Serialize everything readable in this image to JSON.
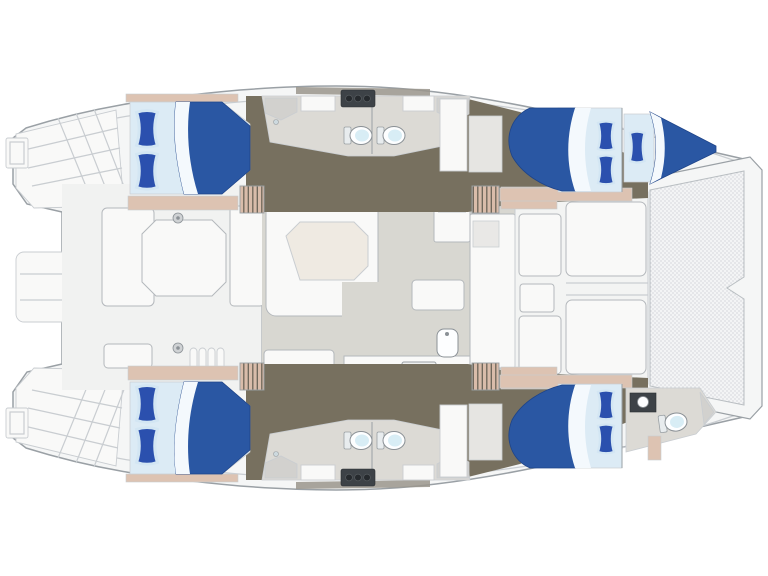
{
  "image": {
    "description": "Top-down 2D floor plan drawing of a sailing catamaran yacht, bow to the right, stern to the left, no visible text",
    "width_px": 768,
    "height_px": 576
  },
  "palette": {
    "deck": "#f5f6f6",
    "deck_line": "#9aa0a5",
    "deck_line_soft": "#c9cdd1",
    "hull_floor": "#77705f",
    "bed_blue_dark": "#1e4489",
    "cabin_shelf_tan": "#ddc3b2",
    "step_tan": "#d9bcaa",
    "step_stripe": "#6b6458",
    "salon_floor": "#d8d7d1",
    "head_floor": "#dcdad5",
    "furniture": "#f9f9f8",
    "furniture_line": "#b4b8bc",
    "table": "#efeae2",
    "bed_blue": "#2a57a3",
    "pillow_blue": "#2b50ae",
    "pillow_edge": "#d3e6f3",
    "mattress": "#dcebf5",
    "sheet": "#f4f9fd",
    "toilet": "#fdfeff",
    "toilet_bowl": "#d8edf5",
    "dark_counter": "#3d4247",
    "dark_knob": "#262a2e",
    "trampoline": "#f3f4f5",
    "tramp_dot": "#c7cbd0",
    "window_band": "#9a958c",
    "gray_fixture": "#d2d1ce",
    "cockpit_floor": "#f1f2f1",
    "fwd_floor": "#f3f4f3"
  },
  "rooms": {
    "hull_silhouette": "Catamaran deck outline with twin transom swim steps aft",
    "aft_platform": "Stern platform between the two transoms",
    "port_transom": "Port transom with swim steps and boarding ladder",
    "starboard_transom": "Starboard transom with swim steps and boarding ladder",
    "aft_cockpit": "Aft cockpit with octagonal table and wrap-around seating",
    "salon": "Salon with L-shaped settee and table",
    "galley": "Galley with 4-burner stove, sink, island and counters",
    "forward_cockpit": "Forward cockpit with two benches, side seats and small table",
    "trampoline": "Bow trampoline net between the hulls",
    "port_aft_cabin": "Port aft double cabin with blue bedding and two pillows",
    "port_heads": "Port hull bathrooms with two toilets and vanity",
    "port_forward_cabin": "Port forward double cabin with blue bedding and two pillows",
    "port_bow_berth": "Port bow single berth with one pillow",
    "starboard_aft_cabin": "Starboard aft double cabin with blue bedding and two pillows",
    "starboard_heads": "Starboard hull bathrooms with two toilets and vanity",
    "starboard_forward_cabin": "Starboard forward double cabin with blue bedding and two pillows",
    "starboard_bow_head": "Starboard bow bathroom with toilet and sink"
  },
  "inventory": {
    "double_beds": 4,
    "single_bow_berths": 1,
    "toilets": 5,
    "stove_burners": 4,
    "galley_sinks": 1,
    "tables": 3,
    "companionway_stairs": 4,
    "trampolines": 1
  }
}
